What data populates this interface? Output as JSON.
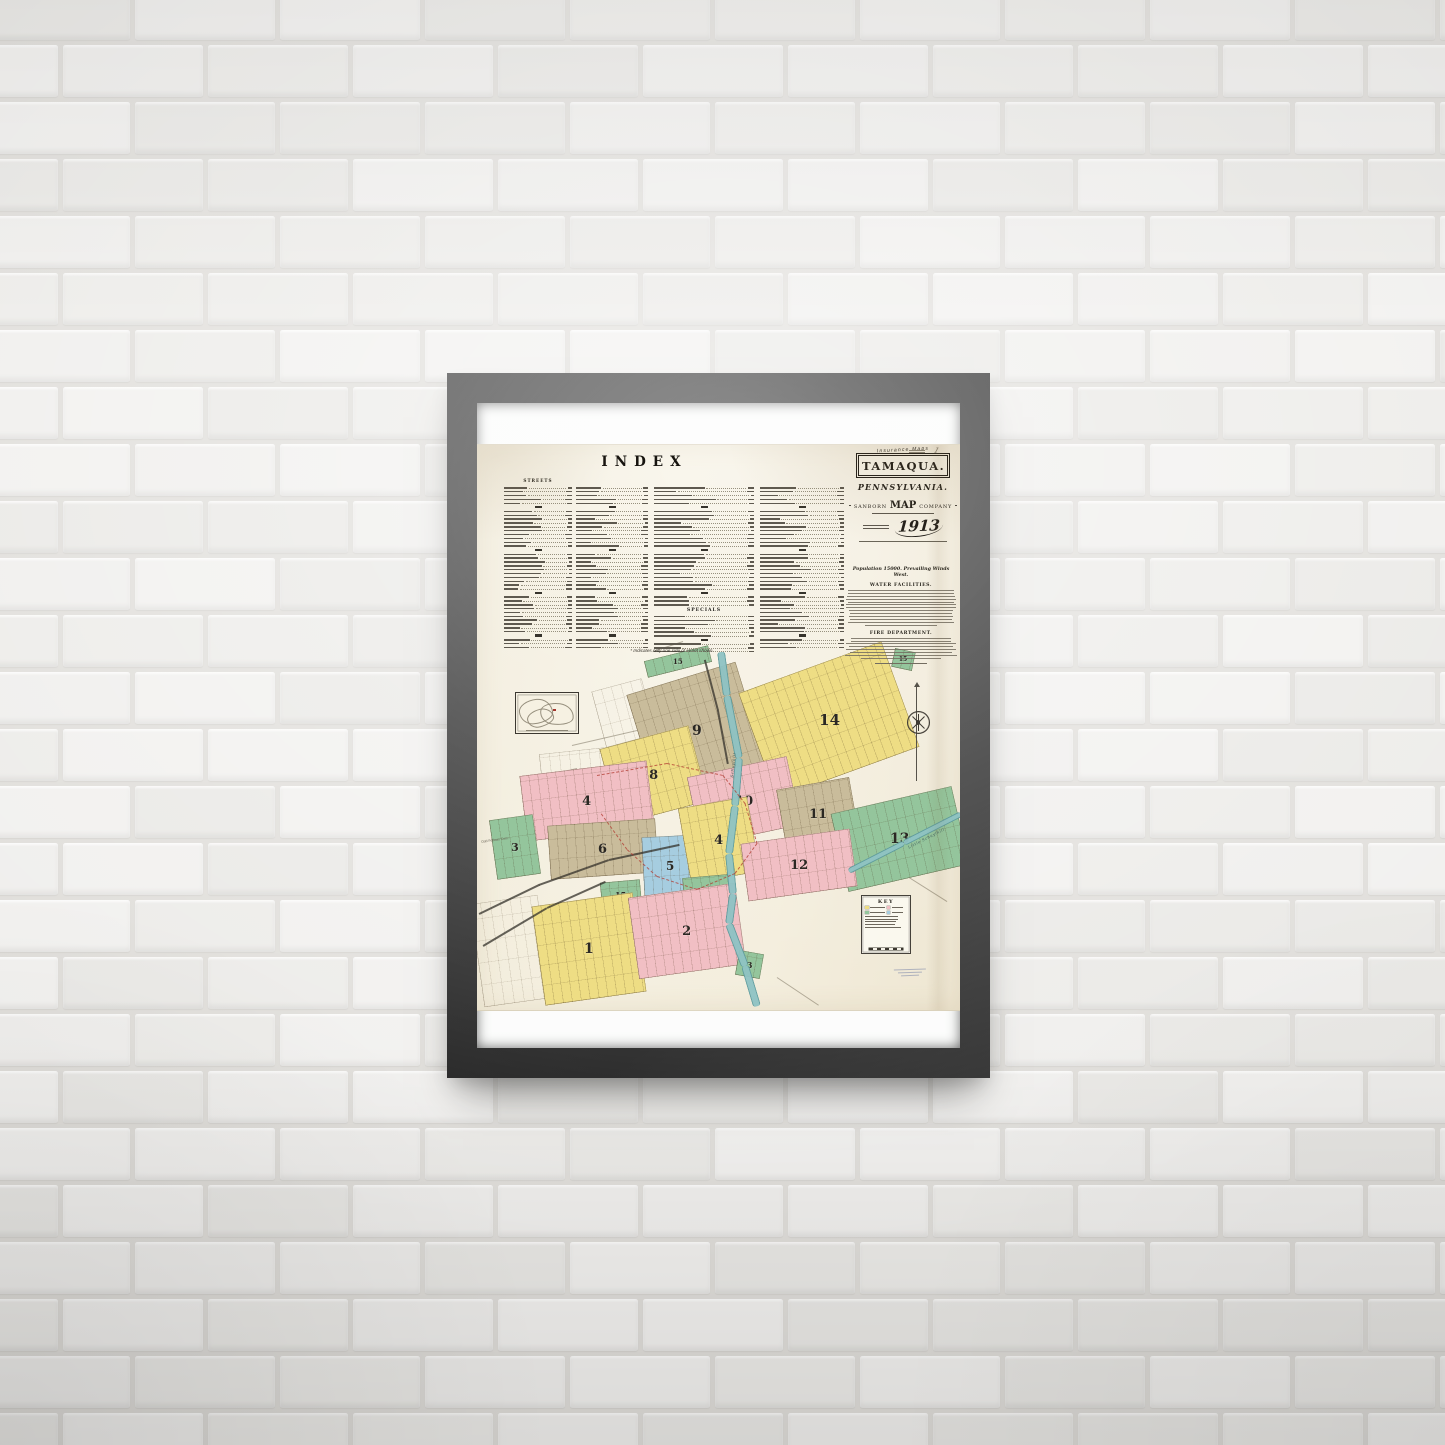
{
  "scene": {
    "wall_color": "#dfddd9",
    "brick_colors": [
      "#efeeec",
      "#ecebe8",
      "#f1f0ee",
      "#e9e8e5"
    ],
    "frame_color": "#1a1a1a"
  },
  "sheet": {
    "colors": {
      "yellow": "#eedd84",
      "pink": "#f1bfc4",
      "tan": "#c9bc9b",
      "green": "#94c59c",
      "blue": "#a6cde0",
      "river": "#8fc3c4",
      "paper": "#f1ead7",
      "ink": "#2b2823",
      "red": "#b23a30"
    },
    "index": {
      "title": "INDEX",
      "col1_header": "STREETS",
      "specials_header": "SPECIALS",
      "footnote": "* Indicates only one side of street shown.",
      "columns": [
        {
          "x": 27,
          "w": 68,
          "rows": 42,
          "specials": false
        },
        {
          "x": 99,
          "w": 72,
          "rows": 42,
          "specials": false
        },
        {
          "x": 177,
          "w": 100,
          "rows": 42,
          "specials": true
        },
        {
          "x": 283,
          "w": 84,
          "rows": 42,
          "specials": false
        }
      ]
    },
    "title_block": {
      "kicker": "Insurance Maps",
      "city": "TAMAQUA.",
      "state": "PENNSYLVANIA.",
      "publisher_left": "SANBORN",
      "publisher_mid": "MAP",
      "publisher_right": "COMPANY",
      "year": "1913"
    },
    "info_block": {
      "population_line": "Population 15000. Prevailing Winds West.",
      "water_header": "WATER FACILITIES.",
      "water_lines": 13,
      "fire_header": "FIRE DEPARTMENT.",
      "fire_lines": 8
    },
    "key": {
      "title": "KEY"
    },
    "corner_note": "1",
    "cemetery_label": "Odd Fellows Cem.",
    "map": {
      "districts": [
        {
          "n": "15",
          "c": "green",
          "x": 201,
          "y": 216,
          "w": 66,
          "h": 17,
          "r": -14,
          "fs": 7
        },
        {
          "n": "15",
          "c": "green",
          "x": 426,
          "y": 214,
          "w": 21,
          "h": 19,
          "r": 12,
          "fs": 6
        },
        {
          "n": "9",
          "c": "tan",
          "x": 220,
          "y": 286,
          "w": 114,
          "h": 110,
          "r": -17,
          "fs": 14
        },
        {
          "n": "14",
          "c": "yellow",
          "x": 352,
          "y": 275,
          "w": 152,
          "h": 112,
          "r": -20,
          "fs": 15
        },
        {
          "n": "8",
          "c": "yellow",
          "x": 177,
          "y": 330,
          "w": 92,
          "h": 78,
          "r": -15,
          "fs": 13
        },
        {
          "n": "10",
          "c": "pink",
          "x": 267,
          "y": 356,
          "w": 102,
          "h": 70,
          "r": -12,
          "fs": 13
        },
        {
          "n": "11",
          "c": "tan",
          "x": 341,
          "y": 369,
          "w": 74,
          "h": 62,
          "r": -10,
          "fs": 13
        },
        {
          "n": "13",
          "c": "green",
          "x": 423,
          "y": 394,
          "w": 124,
          "h": 80,
          "r": -13,
          "fs": 14
        },
        {
          "n": "4",
          "c": "pink",
          "x": 110,
          "y": 356,
          "w": 128,
          "h": 66,
          "r": -7,
          "fs": 13
        },
        {
          "n": "6",
          "c": "tan",
          "x": 126,
          "y": 404,
          "w": 108,
          "h": 54,
          "r": -4,
          "fs": 13
        },
        {
          "n": "3",
          "c": "green",
          "x": 38,
          "y": 402,
          "w": 44,
          "h": 60,
          "r": -8,
          "fs": 11
        },
        {
          "n": "5",
          "c": "blue",
          "x": 193,
          "y": 421,
          "w": 54,
          "h": 60,
          "r": -3,
          "fs": 12
        },
        {
          "n": "4",
          "c": "yellow",
          "x": 242,
          "y": 395,
          "w": 70,
          "h": 76,
          "r": -10,
          "fs": 13
        },
        {
          "n": "12",
          "c": "pink",
          "x": 322,
          "y": 420,
          "w": 110,
          "h": 58,
          "r": -8,
          "fs": 13
        },
        {
          "n": "3",
          "c": "green",
          "x": 230,
          "y": 452,
          "w": 46,
          "h": 42,
          "r": -5,
          "fs": 11
        },
        {
          "n": "15",
          "c": "green",
          "x": 144,
          "y": 449,
          "w": 40,
          "h": 27,
          "r": -5,
          "fs": 8
        },
        {
          "n": "1",
          "c": "yellow",
          "x": 112,
          "y": 504,
          "w": 102,
          "h": 100,
          "r": -8,
          "fs": 14
        },
        {
          "n": "2",
          "c": "pink",
          "x": 210,
          "y": 486,
          "w": 108,
          "h": 82,
          "r": -8,
          "fs": 13
        },
        {
          "n": "3",
          "c": "green",
          "x": 272,
          "y": 519,
          "w": 25,
          "h": 25,
          "r": 10,
          "fs": 8
        }
      ],
      "outline_areas": [
        {
          "x": 34,
          "y": 506,
          "w": 68,
          "h": 104,
          "r": -8
        },
        {
          "x": 122,
          "y": 316,
          "w": 118,
          "h": 26,
          "r": -6
        },
        {
          "x": 147,
          "y": 268,
          "w": 52,
          "h": 58,
          "r": -15
        }
      ],
      "river": [
        [
          244,
          206
        ],
        [
          250,
          250
        ],
        [
          262,
          312
        ],
        [
          258,
          360
        ],
        [
          252,
          408
        ],
        [
          256,
          448
        ],
        [
          252,
          478
        ],
        [
          268,
          520
        ],
        [
          280,
          560
        ]
      ],
      "tributary": [
        [
          484,
          368
        ],
        [
          427,
          397
        ],
        [
          372,
          425
        ]
      ],
      "railroads": [
        [
          [
            2,
            468
          ],
          [
            62,
            439
          ],
          [
            132,
            414
          ],
          [
            202,
            399
          ]
        ],
        [
          [
            228,
            214
          ],
          [
            241,
            264
          ],
          [
            251,
            318
          ]
        ],
        [
          [
            6,
            500
          ],
          [
            70,
            462
          ],
          [
            128,
            436
          ]
        ]
      ],
      "redline": [
        [
          120,
          330
        ],
        [
          190,
          318
        ],
        [
          246,
          330
        ],
        [
          268,
          358
        ],
        [
          280,
          398
        ],
        [
          258,
          428
        ],
        [
          220,
          444
        ],
        [
          180,
          431
        ],
        [
          150,
          404
        ],
        [
          124,
          368
        ]
      ],
      "roads": [
        [
          [
            95,
            300
          ],
          [
            160,
            285
          ]
        ],
        [
          [
            60,
            332
          ],
          [
            100,
            323
          ]
        ],
        [
          [
            300,
            532
          ],
          [
            342,
            560
          ]
        ],
        [
          [
            432,
            432
          ],
          [
            470,
            456
          ]
        ],
        [
          [
            206,
            196
          ],
          [
            176,
            206
          ]
        ]
      ],
      "labels": [
        {
          "t": "Schuylkill",
          "x": 252,
          "y": 332,
          "r": -83
        },
        {
          "t": "Little Schuylkill",
          "x": 430,
          "y": 400,
          "r": -27
        }
      ]
    }
  }
}
